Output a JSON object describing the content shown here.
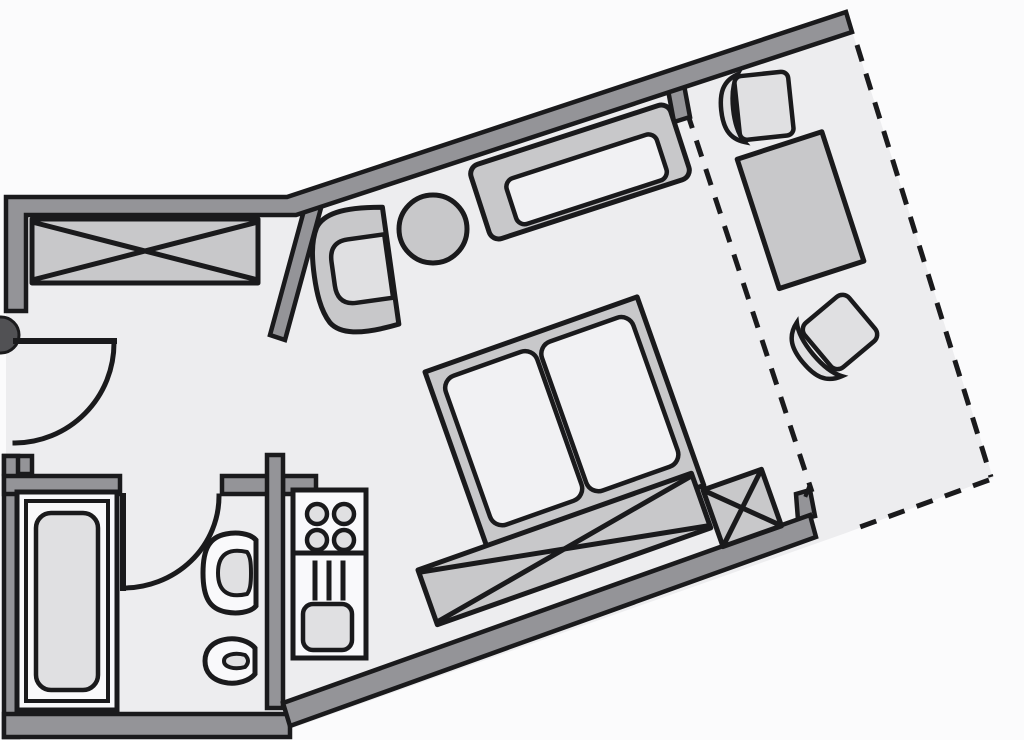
{
  "meta": {
    "title": "Apartment floor plan — studio apartment with balcony",
    "canvas_width": 1024,
    "canvas_height": 740
  },
  "palette": {
    "outside": "#fbfbfc",
    "floor": "#ededef",
    "wall": "#949498",
    "outline": "#1a1a1c",
    "furniture": "#c8c8ca",
    "furniture_light": "#e0e0e2",
    "soft_white": "#f1f1f3",
    "fixture_white": "#f9f9fb",
    "knob": "#515154"
  },
  "floor_plan": {
    "rooms": [
      {
        "id": "entry-hall"
      },
      {
        "id": "bathroom"
      },
      {
        "id": "kitchenette-nook"
      },
      {
        "id": "living-sleeping-room"
      },
      {
        "id": "balcony"
      }
    ],
    "furniture": [
      {
        "id": "wardrobe-crossed",
        "room": "entry-hall"
      },
      {
        "id": "armchair",
        "room": "living-sleeping-room"
      },
      {
        "id": "round-side-table",
        "room": "living-sleeping-room"
      },
      {
        "id": "sofa",
        "room": "living-sleeping-room"
      },
      {
        "id": "double-bed",
        "room": "living-sleeping-room",
        "mattresses": 2
      },
      {
        "id": "storage-bench-crossed",
        "room": "living-sleeping-room"
      },
      {
        "id": "storage-cube-crossed",
        "room": "living-sleeping-room"
      },
      {
        "id": "balcony-chair-upper",
        "room": "balcony"
      },
      {
        "id": "balcony-table",
        "room": "balcony"
      },
      {
        "id": "balcony-chair-lower",
        "room": "balcony"
      }
    ],
    "fixtures": [
      {
        "id": "bathtub",
        "room": "bathroom"
      },
      {
        "id": "washbasin",
        "room": "bathroom"
      },
      {
        "id": "toilet",
        "room": "bathroom"
      },
      {
        "id": "kitchenette-unit",
        "room": "kitchenette-nook",
        "hob_burners": 4,
        "rack_slats": 3
      }
    ],
    "doors": [
      {
        "id": "entry-door",
        "swing": "quarter-arc"
      },
      {
        "id": "bathroom-door",
        "swing": "quarter-arc"
      }
    ],
    "boundaries": [
      {
        "id": "balcony-boundary",
        "style": "dashed"
      }
    ]
  }
}
